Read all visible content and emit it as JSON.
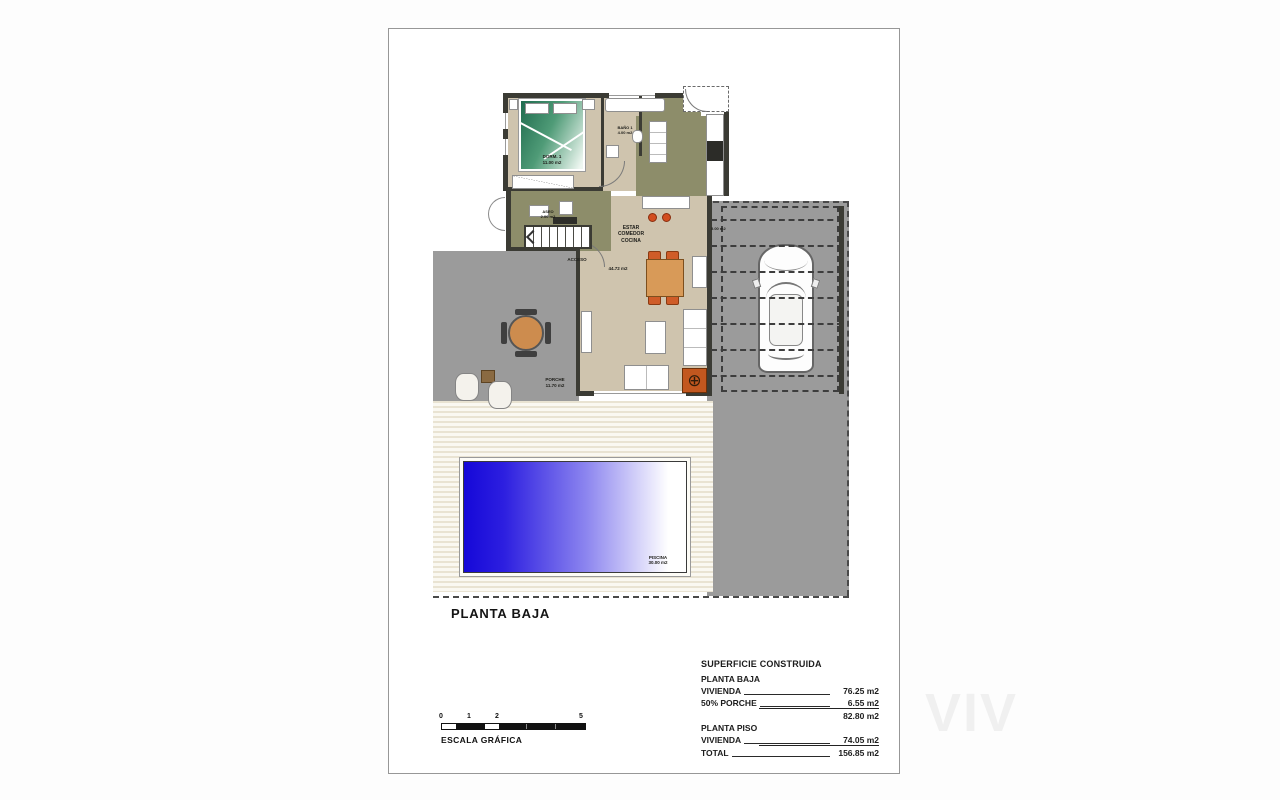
{
  "sheet": {
    "title": "PLANTA BAJA"
  },
  "rooms": {
    "dorm1": "DORM. 1\n11.00 m2",
    "bano1": "BAÑO 1\n4.00 m2",
    "aseo": "ASEO\n2.00 m2",
    "estar": "ESTAR\nCOMEDOR\nCOCINA",
    "estar_area": "44.72 m2",
    "acceso": "ACCESO",
    "porche": "PORCHE\n11.70 m2",
    "pergola_area": "5.00 m2",
    "piscina": "PISCINA\n30.00 m2"
  },
  "summary": {
    "title": "SUPERFICIE CONSTRUIDA",
    "rows": [
      {
        "label": "PLANTA BAJA",
        "value": ""
      },
      {
        "label": "VIVIENDA",
        "value": "76.25 m2"
      },
      {
        "label": "50% PORCHE",
        "value": "6.55 m2"
      },
      {
        "label": "",
        "value": "82.80 m2"
      },
      {
        "label": "PLANTA PISO",
        "value": ""
      },
      {
        "label": "VIVIENDA",
        "value": "74.05 m2"
      },
      {
        "label": "TOTAL",
        "value": "156.85 m2"
      }
    ]
  },
  "scale_bar": {
    "label": "ESCALA GRÁFICA",
    "tick0": "0",
    "tick1": "1",
    "tick2": "2",
    "tick5": "5"
  },
  "watermark": "VIV",
  "colors": {
    "wall": "#3b3b34",
    "floor_beige": "#cfc4ae",
    "olive_green": "#8d8d6a",
    "terrace_gray": "#9b9b9b",
    "pool_blue": "#1508d8",
    "furniture_orange": "#cf5c28"
  }
}
